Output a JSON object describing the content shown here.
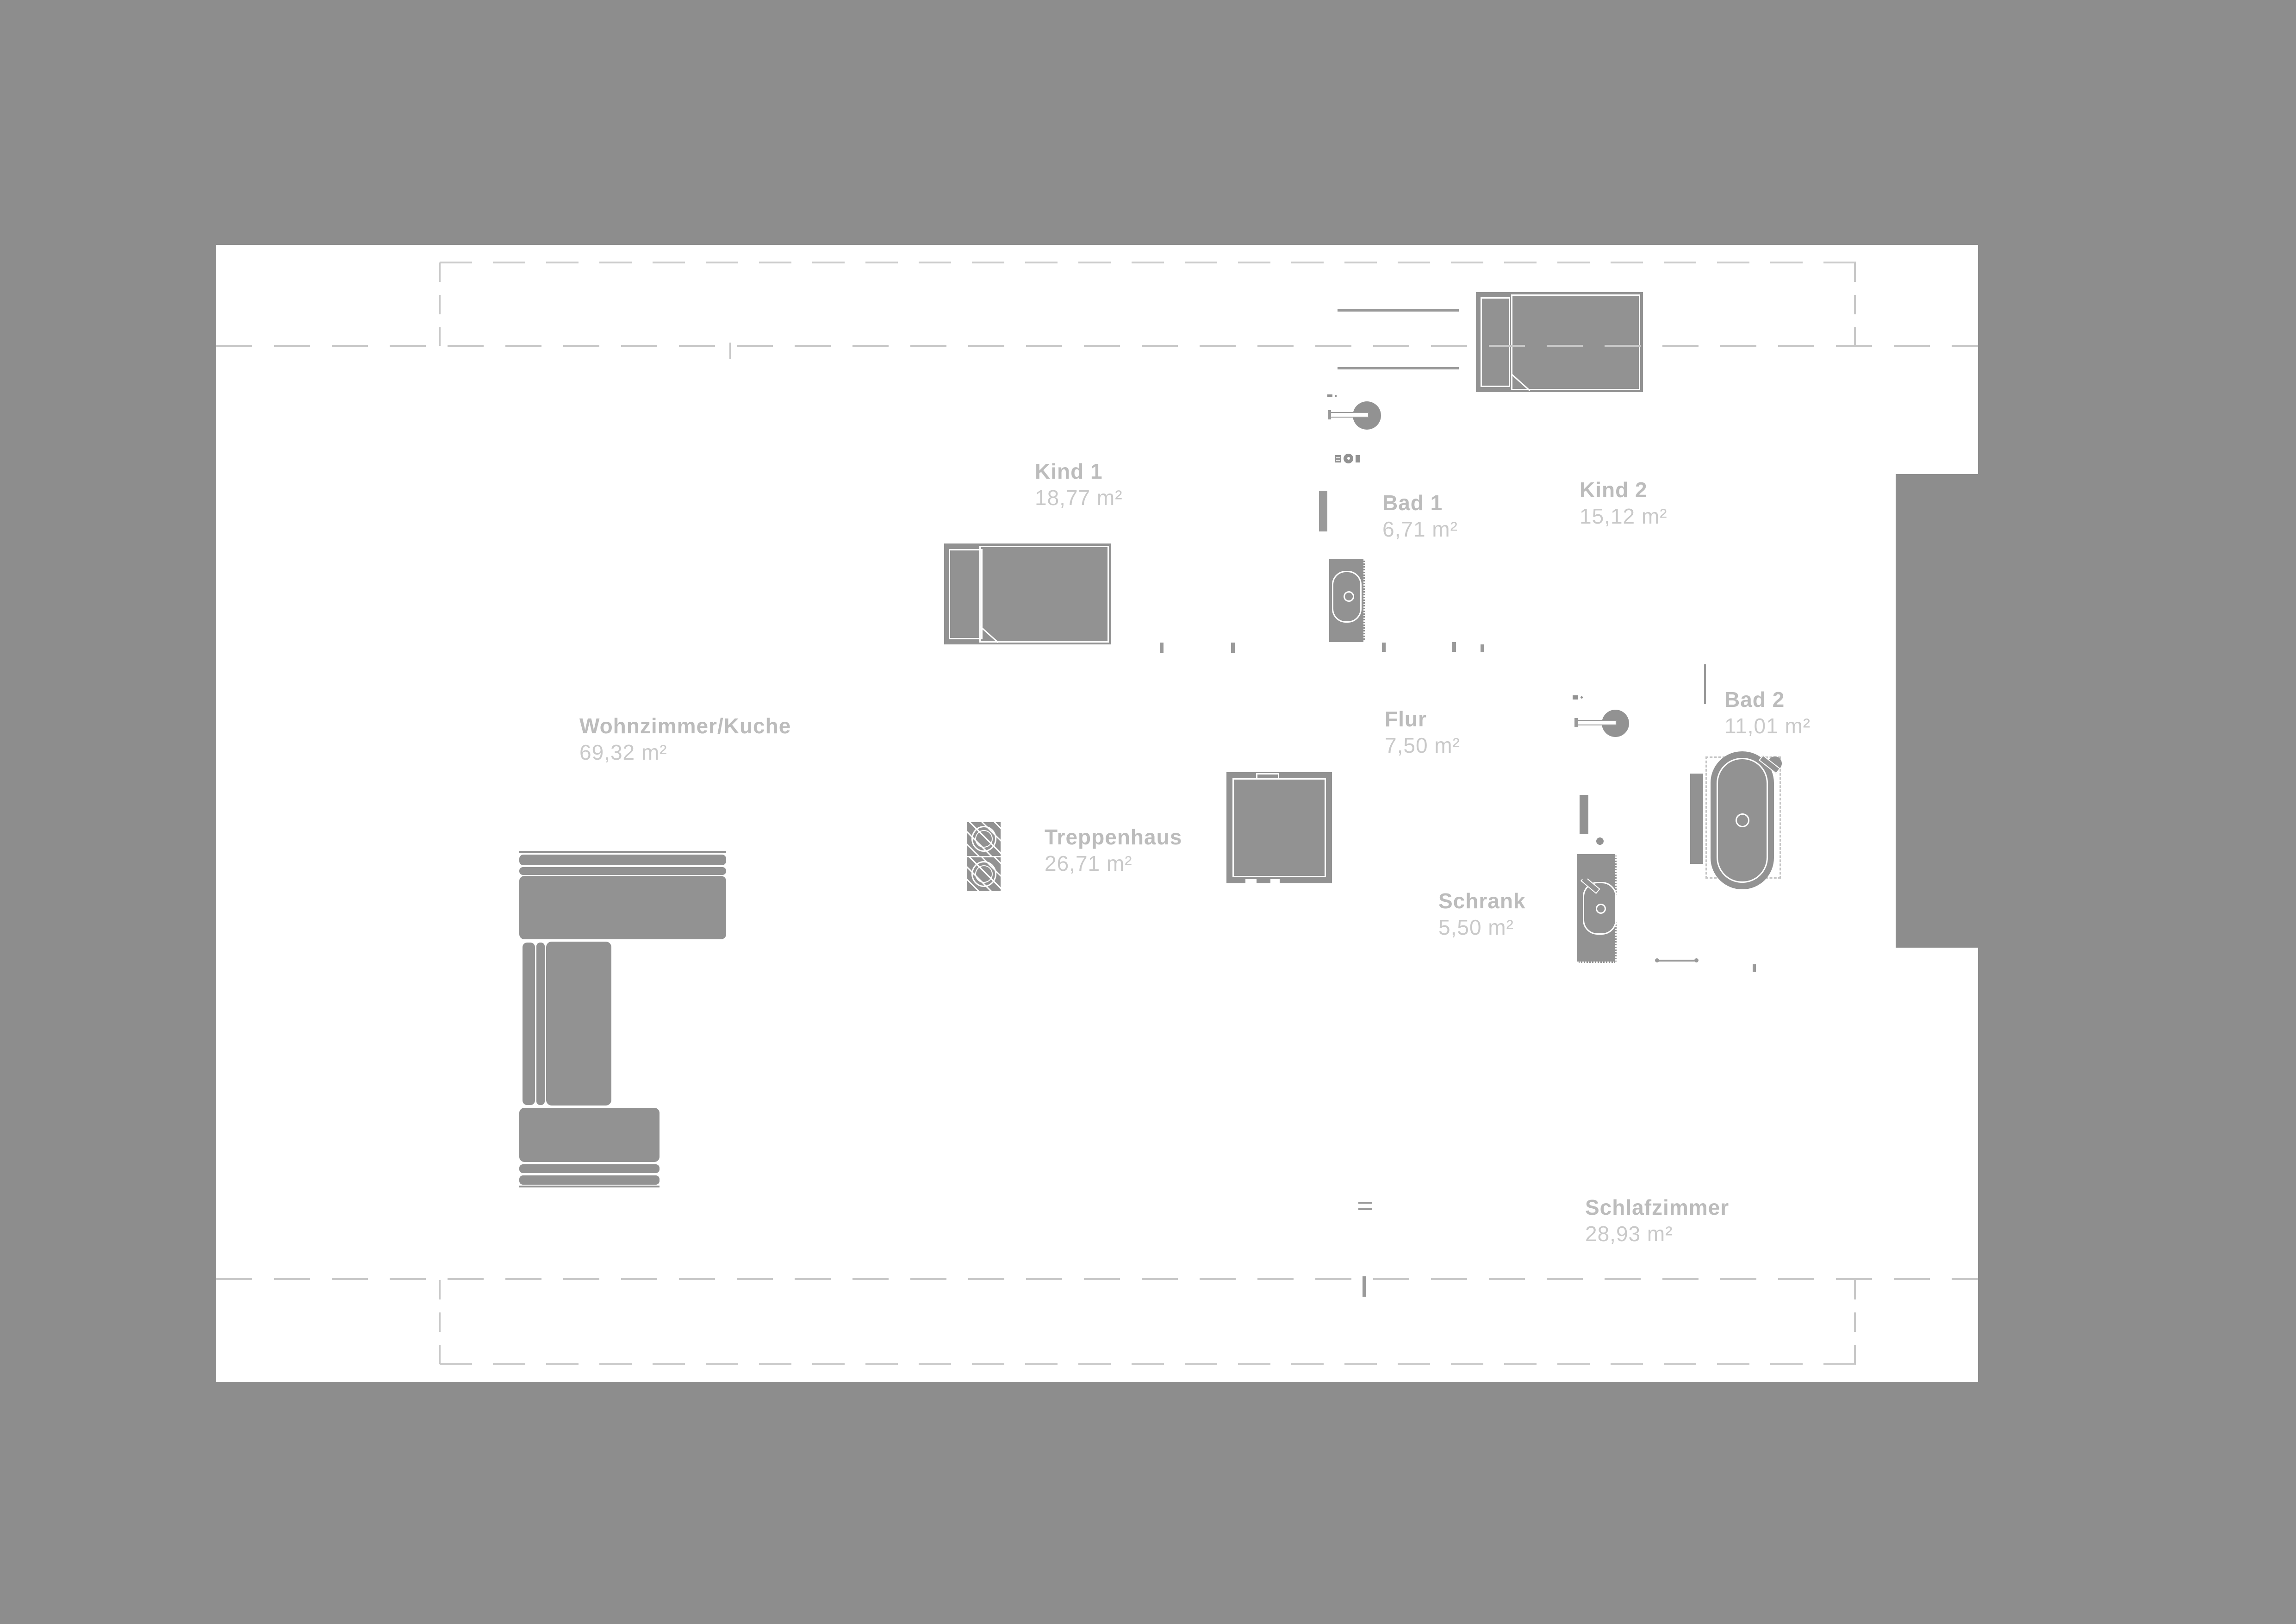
{
  "plan": {
    "type": "floorplan",
    "language": "de",
    "background_color": "#8d8d8d",
    "floor_color": "#ffffff",
    "furniture_color": "#929292",
    "label_name_color": "#bcbcbc",
    "label_area_color": "#c9c9c9",
    "dash_color": "#c8c8c8"
  },
  "rooms": [
    {
      "name": "Kind  1",
      "area": "18,77 m²"
    },
    {
      "name": "Bad 1",
      "area": "6,71 m²"
    },
    {
      "name": "Kind  2",
      "area": "15,12 m²"
    },
    {
      "name": "Wohnzimmer/Kuche",
      "area": "69,32 m²"
    },
    {
      "name": "Flur",
      "area": "7,50 m²"
    },
    {
      "name": "Treppenhaus",
      "area": "26,71 m²"
    },
    {
      "name": "Schrank",
      "area": "5,50 m²"
    },
    {
      "name": "Bad 2",
      "area": "11,01 m²"
    },
    {
      "name": "Schlafzimmer",
      "area": "28,93 m²"
    }
  ],
  "furniture": [
    "bed-kind-1",
    "bed-kind-2",
    "toilet-bad-1",
    "round-sink-bad-1",
    "round-sink-flur",
    "bathtub-bad-2",
    "radiator-bad-2",
    "washbasin-cabinet",
    "wardrobe-door",
    "sofa-sectional",
    "washer-dryer-stack",
    "staircase-shaft",
    "ceiling-lamp-symbol",
    "dimension-line"
  ]
}
